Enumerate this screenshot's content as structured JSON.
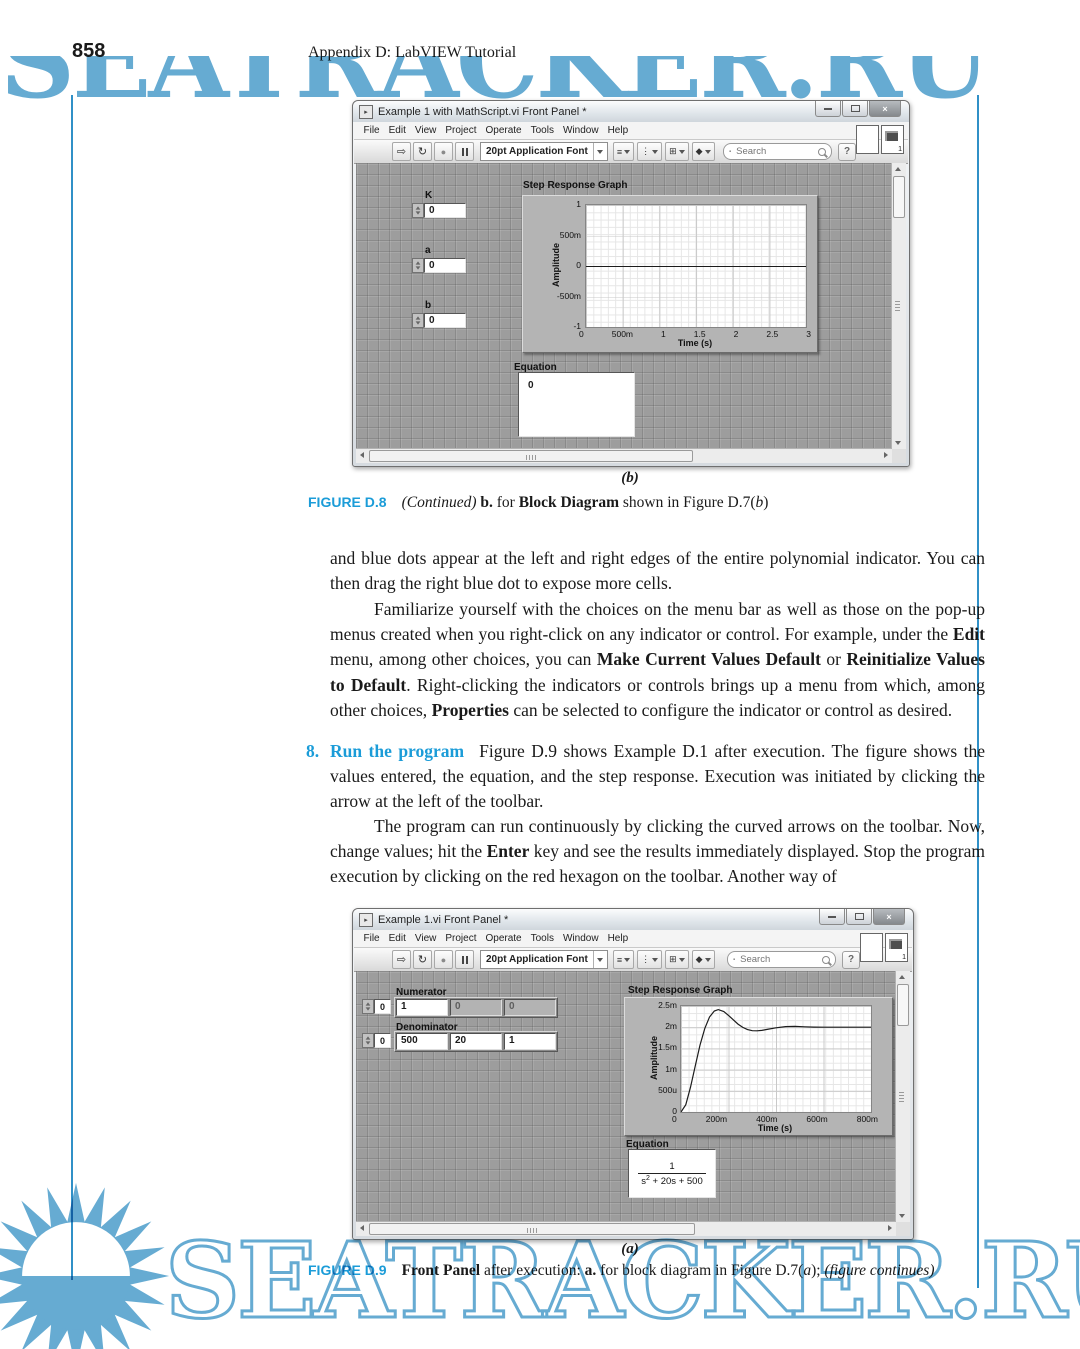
{
  "page": {
    "number": "858",
    "running_head": "Appendix D: LabVIEW Tutorial"
  },
  "colors": {
    "caption_blue": "#1b9cd8",
    "watermark_blue": "#66abd2",
    "margin_rule_blue": "#3090c7",
    "panel_gray": "#9d9d9d"
  },
  "window1": {
    "title": "Example 1 with MathScript.vi Front Panel *",
    "menu": [
      "File",
      "Edit",
      "View",
      "Project",
      "Operate",
      "Tools",
      "Window",
      "Help"
    ],
    "toolbar": {
      "run_icon": "⇨",
      "run_continuous_icon": "↻",
      "abort_icon": "●",
      "font_selector": "20pt Application Font",
      "tools": [
        {
          "glyph": "≡"
        },
        {
          "glyph": "⋮"
        },
        {
          "glyph": "⊞"
        },
        {
          "glyph": "◆"
        }
      ],
      "search_placeholder": "Search",
      "help_label": "?",
      "vi_badge": "1"
    },
    "controls": [
      {
        "label": "K",
        "value": "0"
      },
      {
        "label": "a",
        "value": "0"
      },
      {
        "label": "b",
        "value": "0"
      }
    ],
    "graph": {
      "title": "Step Response Graph",
      "ylabel": "Amplitude",
      "xlabel": "Time (s)",
      "yticks": [
        "1",
        "500m",
        "0",
        "-500m",
        "-1"
      ],
      "xticks": [
        "0",
        "500m",
        "1",
        "1.5",
        "2",
        "2.5",
        "3"
      ]
    },
    "equation": {
      "label": "Equation",
      "value": "0"
    }
  },
  "window2": {
    "title": "Example 1.vi Front Panel *",
    "menu": [
      "File",
      "Edit",
      "View",
      "Project",
      "Operate",
      "Tools",
      "Window",
      "Help"
    ],
    "toolbar": {
      "run_icon": "⇨",
      "run_continuous_icon": "↻",
      "abort_icon": "●",
      "font_selector": "20pt Application Font",
      "tools": [
        {
          "glyph": "≡"
        },
        {
          "glyph": "⋮"
        },
        {
          "glyph": "⊞"
        },
        {
          "glyph": "◆"
        }
      ],
      "search_placeholder": "Search",
      "help_label": "?",
      "vi_badge": "1"
    },
    "numerator": {
      "label": "Numerator",
      "index": "0",
      "cells": [
        "1",
        "0",
        "0"
      ]
    },
    "denominator": {
      "label": "Denominator",
      "index": "0",
      "cells": [
        "500",
        "20",
        "1"
      ]
    },
    "graph": {
      "title": "Step Response Graph",
      "ylabel": "Amplitude",
      "xlabel": "Time (s)",
      "yticks": [
        "2.5m",
        "2m",
        "1.5m",
        "1m",
        "500u",
        "0"
      ],
      "xticks": [
        "0",
        "200m",
        "400m",
        "600m",
        "800m"
      ]
    },
    "equation": {
      "label": "Equation",
      "num": "1",
      "den_base": "s",
      "den_sup": "2",
      "den_rest": " + 20s + 500"
    }
  },
  "captions": {
    "sub_b": "(b)",
    "sub_a": "(a)",
    "d8": {
      "tag": "FIGURE D.8",
      "continued": "(Continued)",
      "b": " b. ",
      "for": "for ",
      "block_diagram": "Block Diagram",
      "rest": " shown in Figure D.7(",
      "b_it": "b",
      "close": ")"
    },
    "d9": {
      "tag": "FIGURE D.9",
      "front_panel": "Front Panel",
      "m1": " after execution: ",
      "a": "a.",
      "m2": " for block diagram in Figure D.7(",
      "a_it": "a",
      "m3": "); ",
      "fc": "(figure continues)"
    }
  },
  "body": {
    "p1": "and blue dots appear at the left and right edges of the entire polynomial indicator. You can then drag the right blue dot to expose more cells.",
    "p2a": "Familiarize yourself with the choices on the menu bar as well as those on the pop-up menus created when you right-click on any indicator or control. For example, under the ",
    "p2b": "Edit",
    "p2c": " menu, among other choices, you can ",
    "p2d": "Make Current Values Default",
    "p2e": " or ",
    "p2f": "Reinitialize Values to Default",
    "p2g": ". Right-clicking the indicators or controls brings up a menu from which, among other choices, ",
    "p2h": "Properties",
    "p2i": " can be selected to configure the indicator or control as desired.",
    "item8_no": "8.",
    "item8_title": "Run the program",
    "item8_t1": "Figure D.9 shows Example D.1 after execution. The figure shows the values entered, the equation, and the step response. Execution was initiated by clicking the arrow at the left of the toolbar.",
    "item8_p2a": "The program can run continuously by clicking the curved arrows on the toolbar. Now, change values; hit the ",
    "item8_p2b": "Enter",
    "item8_p2c": " key and see the results immediately displayed. Stop the program execution by clicking on the red hexagon on the toolbar. Another way of"
  },
  "watermark": {
    "text": "SEATRACKER.RU"
  },
  "chart_data": [
    {
      "type": "line",
      "title": "Step Response Graph",
      "xlabel": "Time (s)",
      "ylabel": "Amplitude",
      "x_unit": "ms",
      "y_unit": "units",
      "xlim": [
        0,
        3000
      ],
      "ylim": [
        -1,
        1
      ],
      "xticks": [
        "0",
        "500m",
        "1",
        "1.5",
        "2",
        "2.5",
        "3"
      ],
      "yticks": [
        "1",
        "500m",
        "0",
        "-500m",
        "-1"
      ],
      "grid": true,
      "legend": false,
      "series": [
        {
          "name": "flat-zero-response",
          "points": [
            [
              0,
              0
            ],
            [
              3000,
              0
            ]
          ]
        }
      ]
    },
    {
      "type": "line",
      "title": "Step Response Graph",
      "xlabel": "Time (s)",
      "ylabel": "Amplitude",
      "x_unit": "ms",
      "y_unit": "micro (1e-6)",
      "xlim": [
        0,
        800
      ],
      "ylim": [
        0,
        2500
      ],
      "xticks": [
        "0",
        "200m",
        "400m",
        "600m",
        "800m"
      ],
      "yticks": [
        "0",
        "500u",
        "1m",
        "1.5m",
        "2m",
        "2.5m"
      ],
      "grid": true,
      "legend": false,
      "series": [
        {
          "name": "step response of 1/(s^2+20s+500)",
          "points": [
            [
              0,
              0
            ],
            [
              20,
              173
            ],
            [
              40,
              585
            ],
            [
              60,
              1091
            ],
            [
              80,
              1577
            ],
            [
              100,
              1972
            ],
            [
              120,
              2241
            ],
            [
              140,
              2382
            ],
            [
              157,
              2416
            ],
            [
              180,
              2370
            ],
            [
              200,
              2279
            ],
            [
              220,
              2174
            ],
            [
              240,
              2074
            ],
            [
              260,
              1996
            ],
            [
              280,
              1944
            ],
            [
              300,
              1918
            ],
            [
              320,
              1914
            ],
            [
              340,
              1925
            ],
            [
              360,
              1945
            ],
            [
              400,
              1987
            ],
            [
              440,
              2013
            ],
            [
              480,
              2018
            ],
            [
              520,
              2010
            ],
            [
              560,
              2003
            ],
            [
              600,
              2000
            ],
            [
              700,
              2000
            ],
            [
              800,
              2000
            ]
          ]
        }
      ]
    }
  ]
}
